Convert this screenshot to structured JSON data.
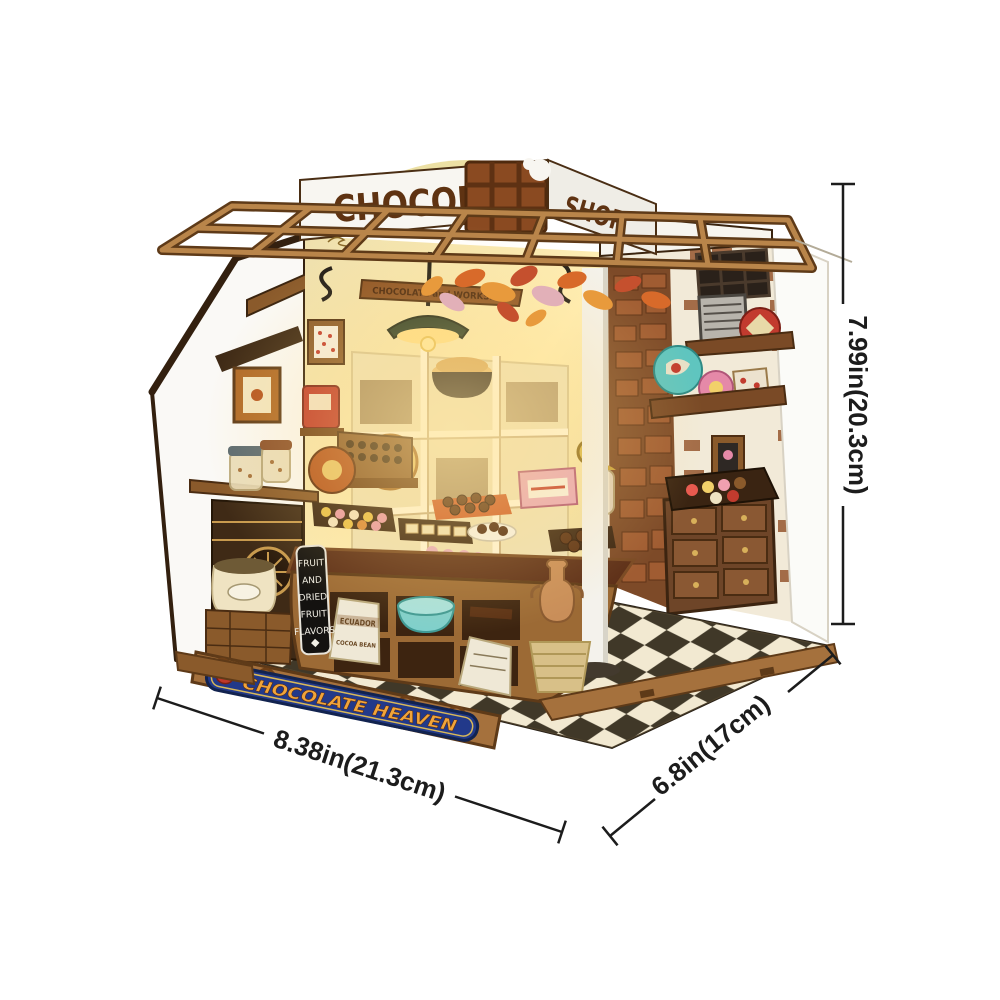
{
  "meta": {
    "description": "Product photo of a DIY miniature chocolate shop book-nook kit shown on a white background with measurement callouts",
    "background_color": "#ffffff"
  },
  "dimensions": {
    "height_label": "7.99in(20.3cm)",
    "width_label": "8.38in(21.3cm)",
    "depth_label": "6.8in(17cm)"
  },
  "signs": {
    "roof_left": "CHOCOLATE",
    "roof_right": "SHOP",
    "front_banner": "CHOCOLATE HEAVEN",
    "hanging_sign": "CHOCOLATE and WORKSHOP",
    "counter_sign_lines": [
      "FRUIT",
      "AND",
      "DRIED",
      "FRUIT",
      "FLAVORS"
    ],
    "cocoa_sack_line1": "ECUADOR",
    "cocoa_sack_line2": "COCOA BEAN"
  },
  "palette": {
    "dimension_color": "#1c1c1c",
    "banner_blue": "#22398a",
    "banner_gold": "#f0a43a",
    "sign_brown": "#5f3312",
    "chocolate_bar": "#8a4a21",
    "trellis_wood": "#b9854a",
    "wall_cream": "#f3e7bb",
    "wall_white": "#faf9f6",
    "brick": "#96572f",
    "floor_dark": "#161412",
    "floor_light": "#efece0",
    "counter_wood": "#8a5a2b",
    "lamp_green": "#2a4431",
    "tin_teal": "#5fc5bf",
    "tin_pink": "#e589a8",
    "tin_red": "#c23b2e",
    "vase_clay": "#c98e59",
    "warm_glow": "#ffdf8f"
  }
}
